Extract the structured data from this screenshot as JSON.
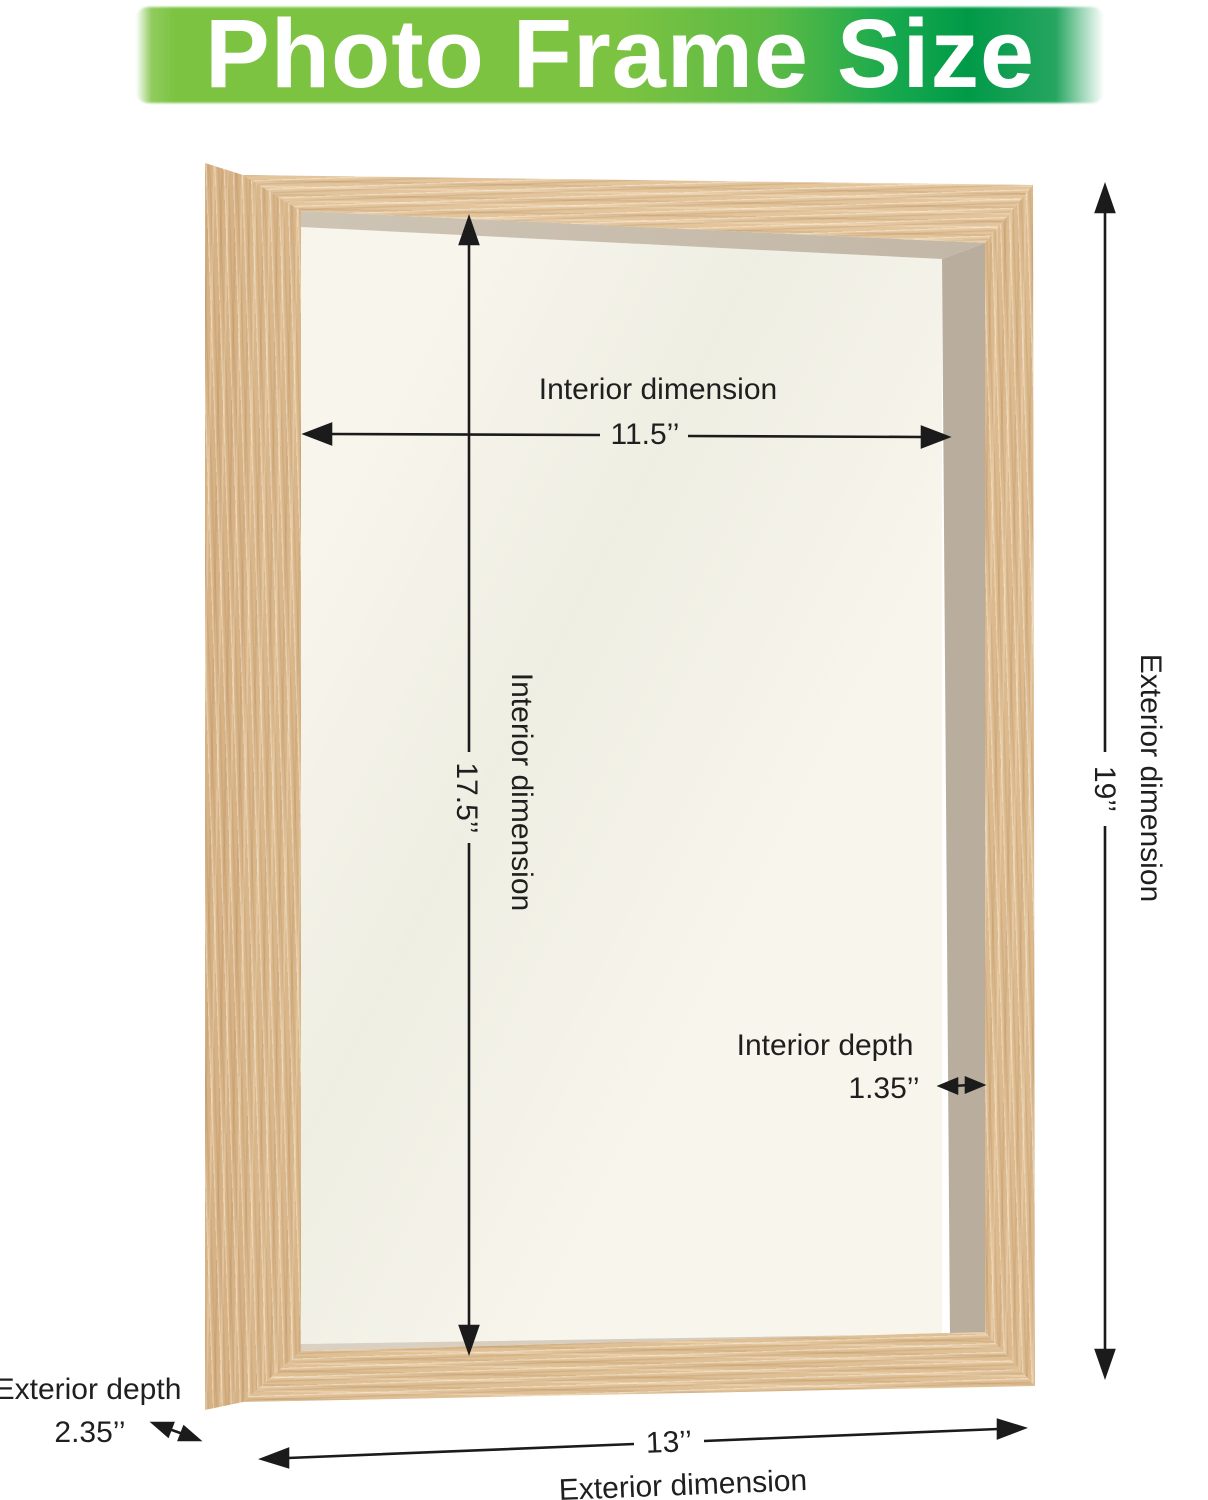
{
  "title": {
    "text": "Photo Frame Size"
  },
  "colors": {
    "banner_green_light": "#7cc342",
    "banner_green_dark": "#009a47",
    "title_text": "#ffffff",
    "wood_front": "#dfbf94",
    "wood_side": "#d7b285",
    "interior_back": "#f8f5ec",
    "interior_wall": "#bfb4a5",
    "dimension_line": "#1b1b1b",
    "label_text": "#1f1f1f"
  },
  "dimensions": {
    "interior_width": {
      "label": "Interior dimension",
      "value": "11.5’’"
    },
    "interior_height": {
      "label": "Interior dimension",
      "value": "17.5’’"
    },
    "interior_depth": {
      "label": "Interior depth",
      "value": "1.35’’"
    },
    "exterior_height": {
      "label": "Exterior dimension",
      "value": "19’’"
    },
    "exterior_width": {
      "label": "Exterior dimension",
      "value": "13’’"
    },
    "exterior_depth": {
      "label": "Exterior depth",
      "value": "2.35’’"
    }
  }
}
